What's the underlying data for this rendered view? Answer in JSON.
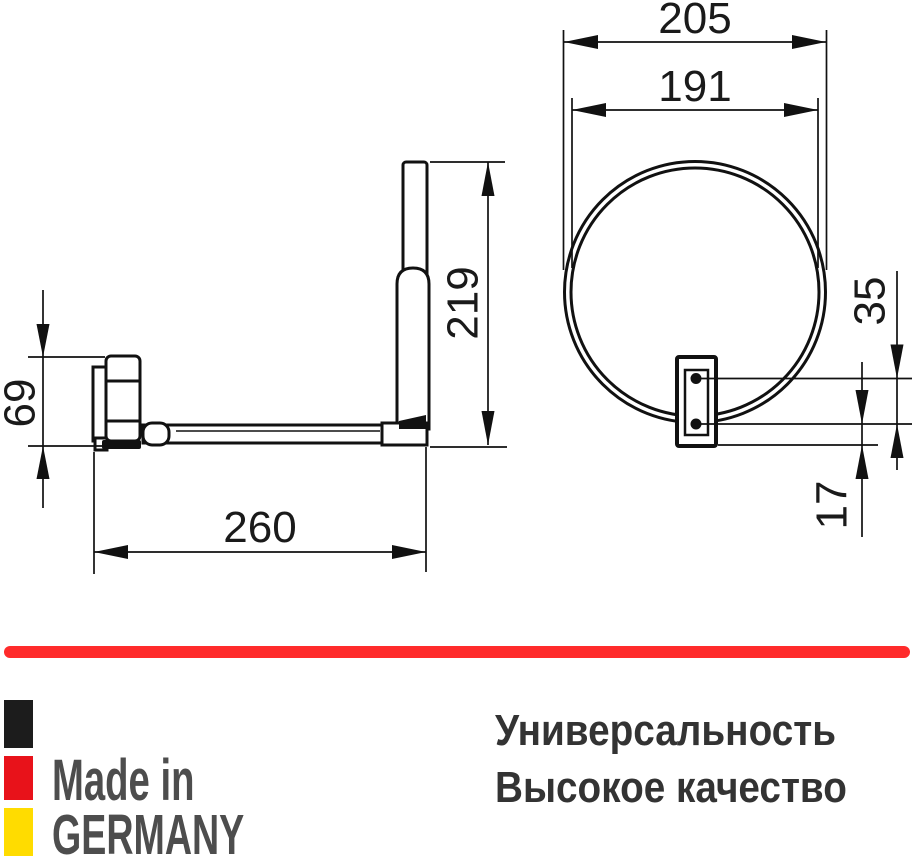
{
  "product_drawing": {
    "side_view": {
      "height_label": "219",
      "bracket_height_label": "69",
      "arm_length_label": "260"
    },
    "front_view": {
      "outer_width_label": "205",
      "mirror_diameter_label": "191",
      "hole_spacing_label": "35",
      "hole_offset_label": "17"
    }
  },
  "footer": {
    "divider_color": "#ff2b2b",
    "flag_colors": {
      "black": "#1c1c1c",
      "red": "#e8121a",
      "yellow": "#ffdc00"
    },
    "made_in_color": "#4d4d4d",
    "made_in_line1": "Made in",
    "made_in_line2": "GERMANY",
    "tagline_color": "#333333",
    "tagline_line1": "Универсальность",
    "tagline_line2": "Высокое качество"
  }
}
